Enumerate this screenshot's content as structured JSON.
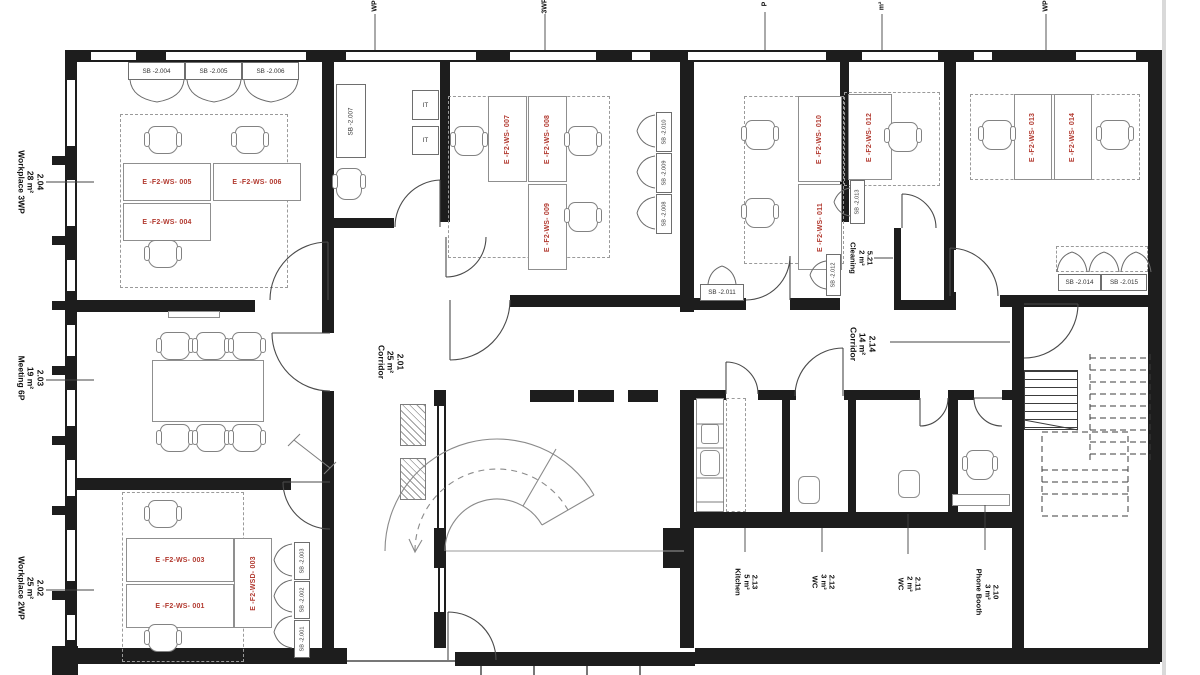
{
  "plan": {
    "rooms": [
      {
        "number": "2.04",
        "area": "28 m²",
        "name": "Workplace 3WP"
      },
      {
        "number": "2.03",
        "area": "19 m²",
        "name": "Meeting 6P"
      },
      {
        "number": "2.02",
        "area": "25 m²",
        "name": "Workplace 2WP"
      },
      {
        "number": "2.01",
        "area": "25 m²",
        "name": "Corridor"
      },
      {
        "number": "2.14",
        "area": "14 m²",
        "name": "Corridor"
      },
      {
        "number": "5.21",
        "area": "2 m²",
        "name": "Cleaning"
      },
      {
        "number": "2.13",
        "area": "5 m²",
        "name": "Kitchen"
      },
      {
        "number": "2.12",
        "area": "3 m²",
        "name": "WC"
      },
      {
        "number": "2.11",
        "area": "2 m²",
        "name": "WC"
      },
      {
        "number": "2.10",
        "area": "3 m²",
        "name": "Phone Booth"
      }
    ],
    "workstations": [
      "E -F2-WS- 005",
      "E -F2-WS- 006",
      "E -F2-WS- 004",
      "E -F2-WS- 007",
      "E -F2-WS- 008",
      "E -F2-WS- 009",
      "E -F2-WS- 010",
      "E -F2-WS- 011",
      "E -F2-WS- 012",
      "E -F2-WS- 013",
      "E -F2-WS- 014",
      "E -F2-WS- 003",
      "E -F2-WS- 001",
      "E -F2-WSD- 003"
    ],
    "sideboards": [
      "SB -2.004",
      "SB -2.005",
      "SB -2.006",
      "SB -2.007",
      "SB -2.010",
      "SB -2.009",
      "SB -2.008",
      "SB -2.011",
      "SB -2.012",
      "SB -2.013",
      "SB -2.014",
      "SB -2.015",
      "SB -2.003",
      "SB -2.002",
      "SB -2.001"
    ],
    "it_label": "IT",
    "cutoff_labels": [
      "WP",
      "3WP",
      "P",
      "m²",
      "WP"
    ],
    "colors": {
      "wall": "#1d1d1d",
      "workstation_label": "#b23a30",
      "furniture_line": "#8f8f8f"
    }
  }
}
